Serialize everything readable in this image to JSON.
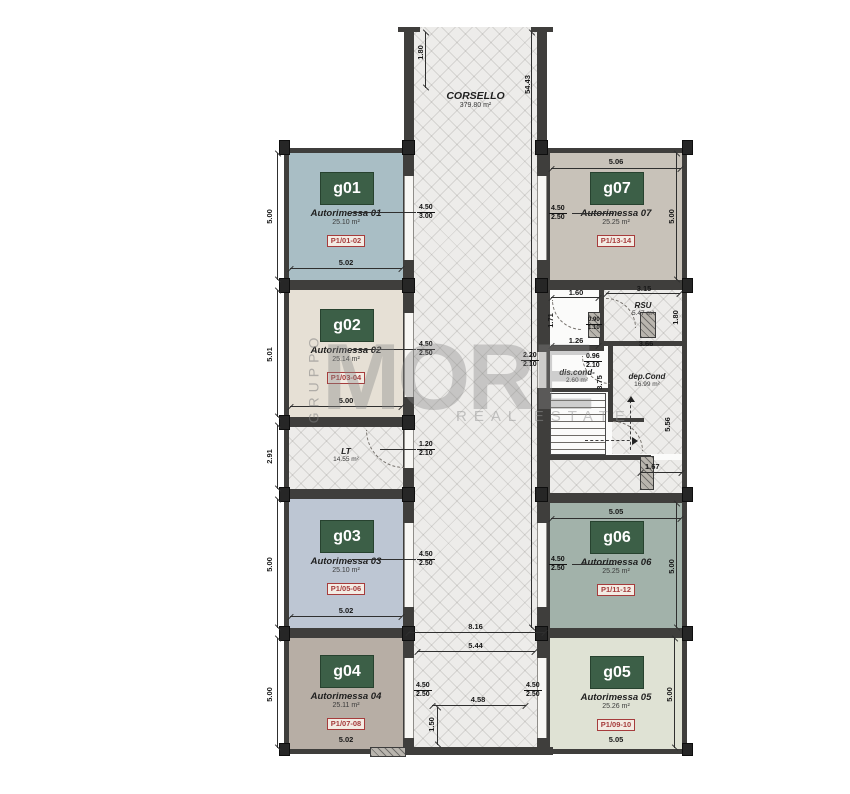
{
  "watermark": {
    "vertical": "GRUPPO",
    "brand": "MORE",
    "tagline": "REAL ESTATE"
  },
  "corridor": {
    "name": "CORSELLO",
    "area": "379.80 m²"
  },
  "units": {
    "g01": {
      "code": "g01",
      "name": "Autorimessa 01",
      "area": "25.10 m²",
      "tag": "P1/01-02"
    },
    "g02": {
      "code": "g02",
      "name": "Autorimessa 02",
      "area": "25.14 m²",
      "tag": "P1/03-04"
    },
    "g03": {
      "code": "g03",
      "name": "Autorimessa 03",
      "area": "25.10 m²",
      "tag": "P1/05-06"
    },
    "g04": {
      "code": "g04",
      "name": "Autorimessa 04",
      "area": "25.11 m²",
      "tag": "P1/07-08"
    },
    "g05": {
      "code": "g05",
      "name": "Autorimessa 05",
      "area": "25.26 m²",
      "tag": "P1/09-10"
    },
    "g06": {
      "code": "g06",
      "name": "Autorimessa 06",
      "area": "25.25 m²",
      "tag": "P1/11-12"
    },
    "g07": {
      "code": "g07",
      "name": "Autorimessa 07",
      "area": "25.25 m²",
      "tag": "P1/13-14"
    }
  },
  "rooms": {
    "lt": {
      "name": "LT",
      "area": "14.55 m²"
    },
    "rsu": {
      "name": "RSU",
      "area": "5.47 m²"
    },
    "dis_cond": {
      "name": "dis.cond-",
      "area": "2.60 m²"
    },
    "dep_cond": {
      "name": "dep.Cond",
      "area": "16.99 m²"
    }
  },
  "dims": {
    "c5443": "54.43",
    "c180": "1.80",
    "g01l": "5.00",
    "g01b": "5.02",
    "g01d1": "4.50",
    "g01d2": "3.00",
    "g02l": "5.01",
    "g02b": "5.00",
    "g02d1": "4.50",
    "g02d2": "2.50",
    "ltl": "2.91",
    "ltd1": "1.20",
    "ltd2": "2.10",
    "g03l": "5.00",
    "g03b": "5.02",
    "g03d1": "4.50",
    "g03d2": "2.50",
    "g04l": "5.00",
    "g04b": "5.02",
    "g04d1": "4.50",
    "g04d2": "2.50",
    "g07t": "5.06",
    "g07r": "5.00",
    "g07d1": "4.50",
    "g07d2": "2.50",
    "g06t": "5.05",
    "g06r": "5.00",
    "g06d1": "4.50",
    "g06d2": "2.50",
    "g05r": "5.00",
    "g05b": "5.05",
    "g05d1": "4.50",
    "g05d2": "2.50",
    "s160": "1.60",
    "s171": "1.71",
    "s315": "3.15",
    "rsu_r": "1.80",
    "s126": "1.26",
    "s366": "3.66",
    "s090": "0.90",
    "s110": "1.10",
    "cd1": "2.20",
    "cd2": "2.10",
    "dd1": "0.96",
    "dd2": "2.10",
    "s375": "3.75",
    "s556": "5.56",
    "s167": "1.67",
    "b816": "8.16",
    "b544": "5.44",
    "b458": "4.58",
    "b150": "1.50"
  },
  "colors": {
    "wall": "#3f3e3c",
    "badge_green": "#3c5f47",
    "tag_red": "#a63c3c",
    "g01": "#a9bec5",
    "g02": "#e6e0d5",
    "g03": "#bdc6d3",
    "g04": "#b7aea5",
    "g05": "#dfe2d4",
    "g06": "#a2b2aa",
    "g07": "#c8c2b9"
  }
}
